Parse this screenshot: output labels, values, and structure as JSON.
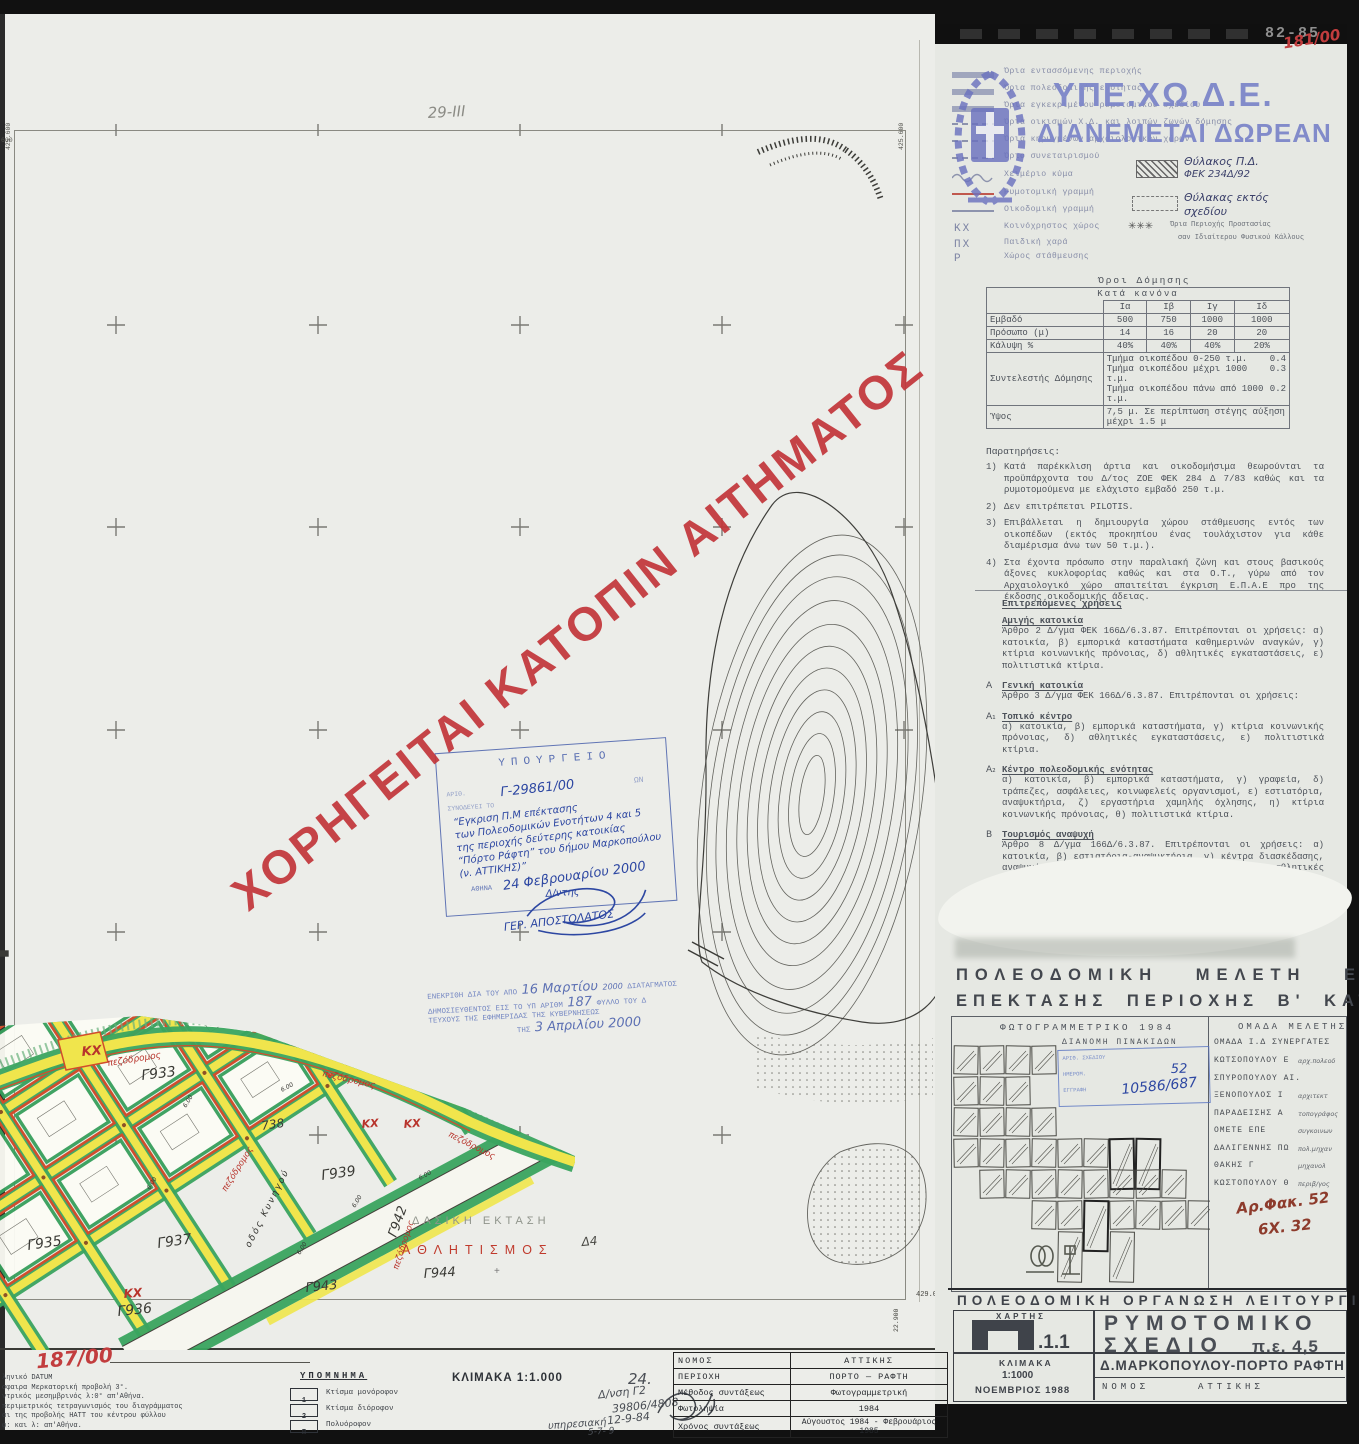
{
  "colors": {
    "accent_red": "#c23d3e",
    "stamp_blue": "#3d56a8",
    "wm_blue": "#7d87c9",
    "road_yellow": "#f0e54c",
    "road_green": "#3aa45f",
    "block_red": "#d14e2c"
  },
  "watermark": {
    "diagonal": "ΧΟΡΗΓΕΙΤΑΙ ΚΑΤΟΠΙΝ ΑΙΤΗΜΑΤΟΣ",
    "ministry": "ΥΠΕ.ΧΩ.Δ.Ε.",
    "ministry_sub": "ΔΙΑΝΕΜΕΤΑΙ ΔΩΡΕΑΝ"
  },
  "annotations": {
    "top_bar_code": "82-85",
    "top_right_ref": "181/00",
    "bottom_left_ref": "187/00",
    "sheet_note": "29-ΙΙΙ",
    "sheet_no": "24.",
    "file_ref1": "Αρ.Φακ. 52",
    "file_ref2": "6Χ. 32",
    "plan_no": "52",
    "protocol_no": "10586/687"
  },
  "legend": {
    "items": [
      {
        "sym": "band",
        "label": "Όρια εντασσόμενης περιοχής"
      },
      {
        "sym": "band",
        "label": "Όρια πολεοδομικής ενότητας"
      },
      {
        "sym": "band",
        "label": "Όρια εγκεκριμένου ρυμοτομικού σχεδίου"
      },
      {
        "sym": "dash",
        "label": "Όρια οικισμών Χ.Δ. και λοιπών ζωνών δόμησης"
      },
      {
        "sym": "dash",
        "label": "Όρια κηρυγμένων αρχαιολογικών χώρων"
      },
      {
        "sym": "dash",
        "label": "Όριο συνεταιρισμού"
      },
      {
        "sym": "wave",
        "label": "Χειμέριο κύμα"
      },
      {
        "sym": "red",
        "label": "Ρυμοτομική γραμμή"
      },
      {
        "sym": "thin",
        "label": "Οικοδομική γραμμή"
      },
      {
        "sym": "code",
        "code": "ΚΧ",
        "label": "Κοινόχρηστος χώρος"
      },
      {
        "sym": "code",
        "code": "ΠΧ",
        "label": "Παιδική χαρά"
      },
      {
        "sym": "code",
        "code": "Ρ",
        "label": "Χώρος στάθμευσης"
      }
    ],
    "right": {
      "pocket1a": "Θύλακος Π.Δ.",
      "pocket1b": "ΦΕΚ 234Δ/92",
      "pocket2a": "Θύλακας εκτός",
      "pocket2b": "σχεδίου",
      "stars": "✳✳✳",
      "stars_label1": "Όρια Περιοχής Προστασίας",
      "stars_label2": "σαν Ιδιαίτερου Φυσικού Κάλλους"
    }
  },
  "building_terms": {
    "title": "Όροι Δόμησης",
    "subtitle": "Κατά κανόνα",
    "columns": [
      "Ια",
      "Ιβ",
      "Ιγ",
      "Ιδ"
    ],
    "rows": [
      {
        "label": "Εμβαδό",
        "values": [
          "500",
          "750",
          "1000",
          "1000"
        ]
      },
      {
        "label": "Πρόσωπο (μ)",
        "values": [
          "14",
          "16",
          "20",
          "20"
        ]
      },
      {
        "label": "Κάλυψη %",
        "values": [
          "40%",
          "40%",
          "40%",
          "20%"
        ]
      }
    ],
    "sd_label": "Συντελεστής Δόμησης",
    "sd_lines": [
      {
        "text": "Τμήμα οικοπέδου 0-250 τ.μ.",
        "value": "0.4"
      },
      {
        "text": "Τμήμα οικοπέδου μέχρι 1000 τ.μ.",
        "value": "0.3"
      },
      {
        "text": "Τμήμα οικοπέδου πάνω από 1000 τ.μ.",
        "value": "0.2"
      }
    ],
    "height_label": "Ύψος",
    "height_value": "7,5 μ. Σε περίπτωση στέγης αύξηση μέχρι 1.5 μ"
  },
  "notes": {
    "title": "Παρατηρήσεις:",
    "items": [
      "Κατά παρέκκλιση άρτια και οικοδομήσιμα θεωρούνται τα προϋπάρχοντα του Δ/τος ΖΟΕ ΦΕΚ 284 Δ 7/83 καθώς και τα ρυμοτομούμενα με ελάχιστο εμβαδό 250 τ.μ.",
      "Δεν επιτρέπεται PILOTIS.",
      "Επιβάλλεται η δημιουργία χώρου στάθμευσης εντός των οικοπέδων (εκτός προκηπίου ένας τουλάχιστον για κάθε διαμέρισμα άνω των 50 τ.μ.).",
      "Στα έχοντα πρόσωπο στην παραλιακή ζώνη και στους βασικούς άξονες κυκλοφορίας καθώς και στα Ο.Τ., γύρω από τον Αρχαιολογικό χώρο απαιτείται έγκριση Ε.Π.Α.Ε προ της έκδοσης οικοδομικής άδειας."
    ]
  },
  "uses": {
    "title": "Επιτρεπόμενες χρήσεις",
    "sections": [
      {
        "prefix": "",
        "heading": "Αμιγής κατοικία",
        "body": "Άρθρο 2 Δ/γμα ΦΕΚ 166Δ/6.3.87. Επιτρέπονται οι χρήσεις: α) κατοικία, β) εμπορικά καταστήματα καθημερινών αναγκών, γ) κτίρια κοινωνικής πρόνοιας, δ) αθλητικές εγκαταστάσεις, ε) πολιτιστικά κτίρια."
      },
      {
        "prefix": "Α",
        "heading": "Γενική κατοικία",
        "body": "Άρθρο 3 Δ/γμα ΦΕΚ 166Δ/6.3.87. Επιτρέπονται οι χρήσεις:"
      },
      {
        "prefix": "Α₁",
        "heading": "Τοπικό κέντρο",
        "body": "α) κατοικία, β) εμπορικά καταστήματα, γ) κτίρια κοινωνικής πρόνοιας, δ) αθλητικές εγκαταστάσεις, ε) πολιτιστικά κτίρια."
      },
      {
        "prefix": "Α₂",
        "heading": "Κέντρο πολεοδομικής ενότητας",
        "body": "α) κατοικία, β) εμπορικά καταστήματα, γ) γραφεία, δ) τράπεζες, ασφάλειες, κοινωφελείς οργανισμοί, ε) εστιατόρια, αναψυκτήρια, ζ) εργαστήρια χαμηλής όχλησης, η) κτίρια κοινωνικής πρόνοιας, θ) πολιτιστικά κτίρια."
      },
      {
        "prefix": "Β",
        "heading": "Τουρισμός αναψυχή",
        "body": "Άρθρο 8 Δ/γμα 166Δ/6.3.87. Επιτρέπονται οι χρήσεις: α) κατοικία, β) εστιατόρια-αναψυκτήρια, γ) κέντρα διασκέδασης, αναψυχής, δ) χώροι συνάθροισης κοινού, ε) αθλητικές εγκαταστάσεις."
      }
    ]
  },
  "study": {
    "title1": "ΠΟΛΕΟΔΟΜΙΚΗ ΜΕΛΕΤΗ ΕΝΤΑΞΗΣ",
    "title2": "ΕΠΕΚΤΑΣΗΣ ΠΕΡΙΟΧΗΣ Β' ΚΑΤΟΙΚΙΑΣ",
    "left_header": "ΦΩΤΟΓΡΑΜΜΕΤΡΙΚΟ 1984",
    "right_header": "ΟΜΑΔΑ ΜΕΛΕΤΗΣ",
    "tiles_header": "ΔΙΑΝΟΜΗ ΠΙΝΑΚΙΔΩΝ",
    "stamp_line1": "ΑΡΙΘ. ΣΧΕΔΙΟΥ",
    "stamp_line2": "ΗΜΕΡΟΜ.",
    "stamp_line3": "ΕΓΓΡΑΦΗ",
    "group_line": "ΟΜΑΔΑ Ι.Δ ΣΥΝΕΡΓΑΤΕΣ",
    "members": [
      {
        "name": "ΚΩΤΣΟΠΟΥΛΟΥ Ε",
        "role": "αρχ.πολεοδ"
      },
      {
        "name": "ΣΠΥΡΟΠΟΥΛΟΥ ΑΙ.",
        "role": ""
      },
      {
        "name": "ΞΕΝΟΠΟΥΛΟΣ Ι",
        "role": "αρχιτεκτ"
      },
      {
        "name": "ΠΑΡΑΔΕΙΣΗΣ Α",
        "role": "τοπογράφος"
      },
      {
        "name": "ΟΜΕΤΕ ΕΠΕ",
        "role": "συγκοινων"
      },
      {
        "name": "ΔΑΛΙΓΕΝΝΗΣ ΠΩ",
        "role": "πολ.μηχαν"
      },
      {
        "name": "ΘΑΚΗΣ Γ",
        "role": "μηχανολ"
      },
      {
        "name": "ΚΩΣΤΟΠΟΥΛΟΥ Θ",
        "role": "περιβ/γος"
      }
    ]
  },
  "footer_right": {
    "title": "ΠΟΛΕΟΔΟΜΙΚΗ ΟΡΓΑΝΩΣΗ ΛΕΙΤΟΥΡΓΙΕΣ",
    "map_label": "ΧΑΡΤΗΣ",
    "map_code": ".1.1",
    "plan1": "ΡΥΜΟΤΟΜΙΚΟ",
    "plan2": "ΣΧΕΔΙΟ",
    "plan_pe": "π.ε. 4,5",
    "scale_label": "ΚΛΙΜΑΚΑ",
    "scale": "1:1000",
    "date": "ΝΟΕΜΒΡΙΟΣ 1988",
    "municipality": "Δ.ΜΑΡΚΟΠΟΥΛΟΥ-ΠΟΡΤΟ ΡΑΦΤΗ",
    "nomos_label": "ΝΟΜΟΣ",
    "nomos": "ΑΤΤΙΚΗΣ"
  },
  "title_block": {
    "datum_lines": [
      "ληνικό DATUM",
      "σφαιρα Μερκατορική προβολή 3°.",
      "ντρικός μεσημβρινός λ:0°  απ'Αθήνα.",
      "περιμετρικός τετραγωνισμός του διαγράμματος",
      "αι της προβολής ΗΑΤΤ του κέντρου φύλλου",
      "φ:            και λ:            απ'Αθήνα."
    ],
    "legend_title": "ΥΠΟΜΝΗΜΑ",
    "items": [
      {
        "code": "1",
        "label": "Κτίσμα μονόροφον"
      },
      {
        "code": "2",
        "label": "Κτίσμα διόροφον"
      },
      {
        "code": "Π",
        "label": "Πολυόροφον"
      }
    ],
    "scale": "ΚΛΙΜΑΚΑ 1:1.000",
    "hand": [
      "Δ/νση Γ2",
      "39806/4808",
      "12-9-84",
      "υπηρεσιακή",
      "24.",
      "5-7-  9"
    ],
    "table": [
      {
        "label": "ΝΟΜΟΣ",
        "value": "ΑΤΤΙΚΗΣ"
      },
      {
        "label": "ΠΕΡΙΟΧΗ",
        "value": "ΠΟΡΤΟ — ΡΑΦΤΗ"
      },
      {
        "label": "Μέθοδος συντάξεως",
        "value": "Φωτογραμμετρική"
      },
      {
        "label": "Φωτοληψία",
        "value": "1984"
      },
      {
        "label": "Χρόνος συντάξεως",
        "value": "Αύγουστος 1984 - Φεβρουάριος 1985"
      }
    ]
  },
  "stamps": {
    "ministry": {
      "header": "ΥΠΟΥΡΓΕΙΟ",
      "sub_right": "ΩΝ",
      "ref1": "ΑΡΙΘ.",
      "ref2": "ΣΥΝΟΔΕΥΕΙ ΤΟ",
      "number": "Γ-29861/00",
      "lines": [
        "“Εγκριση Π.Μ επέκτασης",
        "των Πολεοδομικών Ενοτήτων 4 και 5",
        "της περιοχής δεύτερης κατοικίας",
        "“Πόρτο Ράφτη” του δήμου Μαρκοπούλου",
        "(ν. ΑΤΤΙΚΗΣ)”"
      ],
      "city": "ΑΘΗΝΑ",
      "date": "24 Φεβρουαρίου 2000",
      "role": "Δ/ντης",
      "signature": "ΓΕΡ. ΑΠΟΣΤΟΛΑΤΟΣ"
    },
    "approval": {
      "l1a": "ΕΝΕΚΡΙΘΗ ΔΙΑ ΤΟΥ ΑΠΟ",
      "hw1": "16 Μαρτίου",
      "hw1b": "2000",
      "l1b": "ΔΙΑΤΑΓΜΑΤΟΣ",
      "l2a": "ΔΗΜΟΣΙΕΥΘΕΝΤΟΣ ΕΙΣ ΤΟ ΥΠ ΑΡΙΘΜ",
      "hw2": "187",
      "l2b": "ΦΥΛΛΟ ΤΟΥ Δ",
      "l3": "ΤΕΥΧΟΥΣ ΤΗΣ ΕΦΗΜΕΡΙΔΑΣ ΤΗΣ ΚΥΒΕΡΝΗΣΕΩΣ",
      "l4a": "ΤΗΣ",
      "hw3": "3 Απριλίου 2000"
    }
  },
  "map": {
    "labels": [
      {
        "t": "πεζόδρομος",
        "x": 108,
        "y": 1066,
        "r": -9,
        "s": 9,
        "c": "#b8342c",
        "f": "h"
      },
      {
        "t": "πεζόδρομος",
        "x": 322,
        "y": 1076,
        "r": 13,
        "s": 9,
        "c": "#b8342c",
        "f": "h"
      },
      {
        "t": "πεζόδρομος",
        "x": 226,
        "y": 1192,
        "r": -58,
        "s": 8.5,
        "c": "#b8342c",
        "f": "h"
      },
      {
        "t": "πεζόδρομος",
        "x": 398,
        "y": 1270,
        "r": -72,
        "s": 8.5,
        "c": "#b8342c",
        "f": "h"
      },
      {
        "t": "πεζόδρομος",
        "x": 448,
        "y": 1136,
        "r": 27,
        "s": 8.5,
        "c": "#b8342c",
        "f": "h"
      },
      {
        "t": "ΚΧ",
        "x": 82,
        "y": 1056,
        "r": -5,
        "s": 13,
        "c": "#b8342c",
        "f": "h",
        "b": 1
      },
      {
        "t": "ΚΧ",
        "x": 362,
        "y": 1128,
        "r": -5,
        "s": 11,
        "c": "#b8342c",
        "f": "h",
        "b": 1
      },
      {
        "t": "ΚΧ",
        "x": 404,
        "y": 1128,
        "r": -5,
        "s": 11,
        "c": "#b8342c",
        "f": "h",
        "b": 1
      },
      {
        "t": "ΚΧ",
        "x": 124,
        "y": 1298,
        "r": -5,
        "s": 12,
        "c": "#b8342c",
        "f": "h",
        "b": 1
      },
      {
        "t": "Γ933",
        "x": 142,
        "y": 1080,
        "r": -7,
        "s": 14,
        "c": "#3a3a35",
        "f": "h"
      },
      {
        "t": "Γ935",
        "x": 28,
        "y": 1250,
        "r": -8,
        "s": 14,
        "c": "#3a3a35",
        "f": "h"
      },
      {
        "t": "Γ936",
        "x": 118,
        "y": 1316,
        "r": -6,
        "s": 14,
        "c": "#3a3a35",
        "f": "h"
      },
      {
        "t": "Γ937",
        "x": 158,
        "y": 1248,
        "r": -8,
        "s": 14,
        "c": "#3a3a35",
        "f": "h"
      },
      {
        "t": "Γ939",
        "x": 322,
        "y": 1180,
        "r": -8,
        "s": 14,
        "c": "#3a3a35",
        "f": "h"
      },
      {
        "t": "Γ942",
        "x": 396,
        "y": 1238,
        "r": -70,
        "s": 13,
        "c": "#3a3a35",
        "f": "h"
      },
      {
        "t": "Γ943",
        "x": 306,
        "y": 1292,
        "r": -6,
        "s": 13,
        "c": "#3a3a35",
        "f": "h"
      },
      {
        "t": "Γ944",
        "x": 424,
        "y": 1278,
        "r": -4,
        "s": 13,
        "c": "#3a3a35",
        "f": "h"
      },
      {
        "t": "738",
        "x": 262,
        "y": 1130,
        "r": -8,
        "s": 12,
        "c": "#3a3a35",
        "f": "h"
      },
      {
        "t": "οδός Κυνηγού",
        "x": 250,
        "y": 1248,
        "r": -63,
        "s": 9,
        "c": "#30302c",
        "f": "h",
        "ls": 2
      },
      {
        "t": "ΔΑΣΙΚΗ ΕΚΤΑΣΗ",
        "x": 412,
        "y": 1224,
        "r": 0,
        "s": 11,
        "c": "#8f948b",
        "f": "s",
        "ls": 4
      },
      {
        "t": "ΑΘΛΗΤΙΣΜΟΣ",
        "x": 402,
        "y": 1254,
        "r": 0,
        "s": 12.5,
        "c": "#c03a2c",
        "f": "s",
        "ls": 7
      },
      {
        "t": "Δ4",
        "x": 582,
        "y": 1246,
        "r": -5,
        "s": 12,
        "c": "#4a4a45",
        "f": "h"
      },
      {
        "t": "+",
        "x": 494,
        "y": 1274,
        "r": 0,
        "s": 10,
        "c": "#777",
        "f": "s"
      },
      {
        "t": "6.00",
        "x": 186,
        "y": 1108,
        "r": -58,
        "s": 6,
        "c": "#33332f",
        "f": "h"
      },
      {
        "t": "6.00",
        "x": 282,
        "y": 1092,
        "r": -28,
        "s": 6,
        "c": "#33332f",
        "f": "h"
      },
      {
        "t": "6.00",
        "x": 150,
        "y": 1190,
        "r": -58,
        "s": 6,
        "c": "#33332f",
        "f": "h"
      },
      {
        "t": "6.00",
        "x": 355,
        "y": 1208,
        "r": -58,
        "s": 6,
        "c": "#33332f",
        "f": "h"
      },
      {
        "t": "6.00",
        "x": 300,
        "y": 1255,
        "r": -58,
        "s": 6,
        "c": "#33332f",
        "f": "h"
      },
      {
        "t": "6.00",
        "x": 420,
        "y": 1180,
        "r": -28,
        "s": 6,
        "c": "#33332f",
        "f": "h"
      },
      {
        "t": "29-ΙΙΙ",
        "x": 428,
        "y": 118,
        "r": -3,
        "s": 15,
        "c": "#8b8b85",
        "f": "h"
      },
      {
        "t": "425.600",
        "x": 903,
        "y": 150,
        "r": -90,
        "s": 6.5,
        "c": "#55554f",
        "f": "m"
      },
      {
        "t": "425.600",
        "x": 10,
        "y": 150,
        "r": -90,
        "s": 6.5,
        "c": "#55554f",
        "f": "m"
      },
      {
        "t": "600",
        "x": 1,
        "y": 142,
        "r": 0,
        "s": 6.5,
        "c": "#55554f",
        "f": "m"
      },
      {
        "t": "429.000",
        "x": 916,
        "y": 1296,
        "r": 0,
        "s": 7,
        "c": "#44443f",
        "f": "m"
      },
      {
        "t": "22.900",
        "x": 898,
        "y": 1332,
        "r": -90,
        "s": 6.5,
        "c": "#44443f",
        "f": "m"
      }
    ]
  }
}
